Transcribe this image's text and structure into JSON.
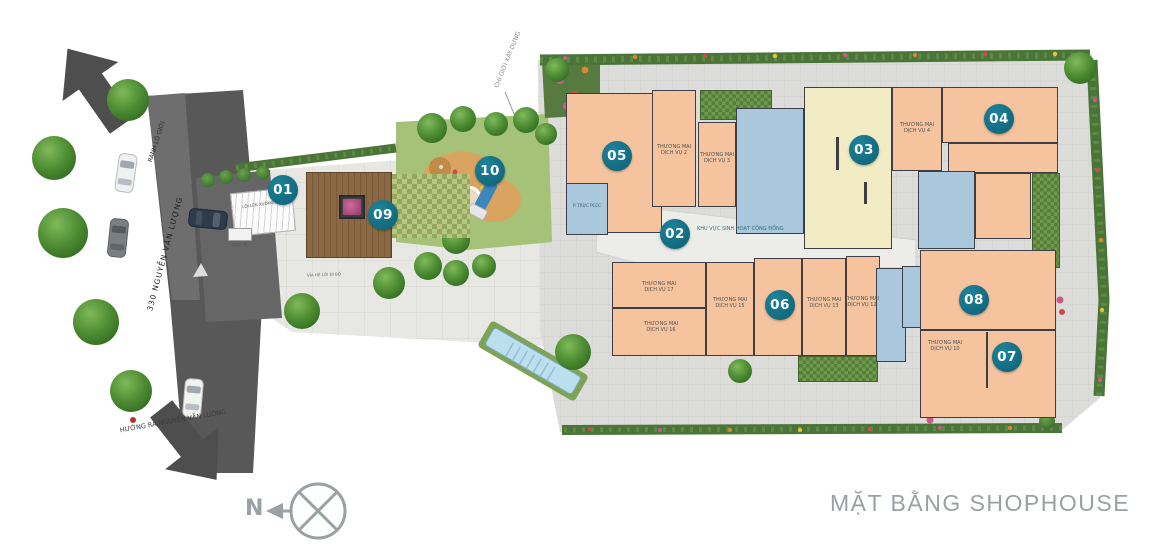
{
  "title": "MẶT BẰNG SHOPHOUSE",
  "compass": {
    "label": "N"
  },
  "road": {
    "name": "330 NGUYỄN VĂN LƯỢNG",
    "boundary_label": "RANH LỘ GIỚI",
    "building_line_label": "CHỈ GIỚI XÂY DỰNG",
    "exit_label": "HƯỚNG RA NGUYỄN VĂN LUÔNG"
  },
  "site": {
    "ramp_label": "LỐI LÊN XUỐNG HẦM 1",
    "security_label": "BẢO VỆ",
    "fire_room_label": "P. TRỰC PCCC",
    "community_label": "KHU VỰC SINH HOẠT CỘNG ĐỒNG",
    "walkway_label": "VỈA HÈ LỐI ĐI BỘ"
  },
  "markers": [
    {
      "label": "01"
    },
    {
      "label": "02"
    },
    {
      "label": "03"
    },
    {
      "label": "04"
    },
    {
      "label": "05"
    },
    {
      "label": "06"
    },
    {
      "label": "07"
    },
    {
      "label": "08"
    },
    {
      "label": "09"
    },
    {
      "label": "10"
    }
  ],
  "rooms": [
    {
      "line1": "THƯƠNG MẠI",
      "line2": "DỊCH VỤ 2"
    },
    {
      "line1": "THƯƠNG MẠI",
      "line2": "DỊCH VỤ 3"
    },
    {
      "line1": "THƯƠNG MẠI",
      "line2": "DỊCH VỤ 4"
    },
    {
      "line1": "THƯƠNG MẠI",
      "line2": "DỊCH VỤ 17"
    },
    {
      "line1": "THƯƠNG MẠI",
      "line2": "DỊCH VỤ 16"
    },
    {
      "line1": "THƯƠNG MẠI",
      "line2": "DỊCH VỤ 15"
    },
    {
      "line1": "THƯƠNG MẠI",
      "line2": "DỊCH VỤ 13"
    },
    {
      "line1": "THƯƠNG MẠI",
      "line2": "DỊCH VỤ 12"
    },
    {
      "line1": "THƯƠNG MẠI",
      "line2": "DỊCH VỤ 10"
    }
  ],
  "colors": {
    "marker": "#12697e",
    "shophouse": "#f5c49f",
    "lobby": "#f1ecc4",
    "service": "#a9c7dd",
    "title-gray": "#9aa0a3"
  }
}
